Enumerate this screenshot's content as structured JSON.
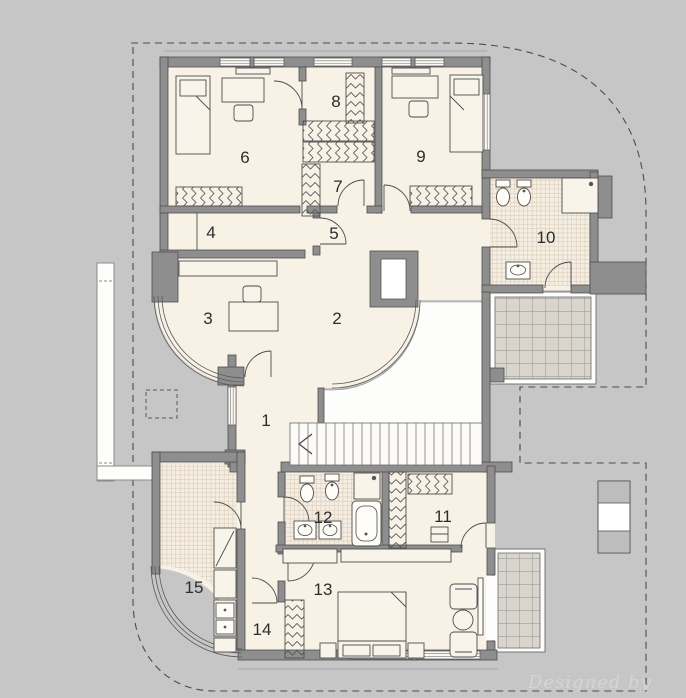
{
  "watermark": "Designed by",
  "rooms": [
    "1",
    "2",
    "3",
    "4",
    "5",
    "6",
    "7",
    "8",
    "9",
    "10",
    "11",
    "12",
    "13",
    "14",
    "15"
  ],
  "palette": {
    "background": "#c6c6c6",
    "wall": "#8e8e8e",
    "floor": "#f7f1e6",
    "bathroom_tile_line": "#cfbaa6",
    "terrace_tile": "#d9d5cc",
    "open_void": "#fdfdfb",
    "watermark_text": "#d5d5d5"
  }
}
